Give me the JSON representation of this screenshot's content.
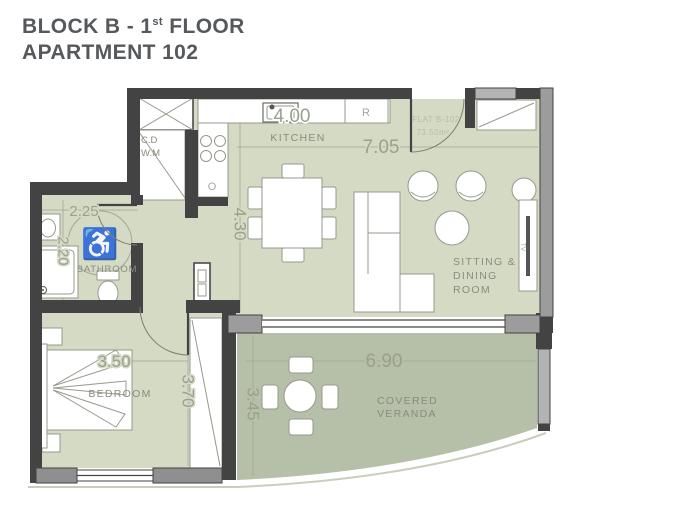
{
  "title": {
    "line1_prefix": "BLOCK B - 1",
    "line1_sup": "st",
    "line1_suffix": " FLOOR",
    "line2": "APARTMENT 102"
  },
  "plan": {
    "flat": {
      "name": "FLAT B-102",
      "area": "73.50m²"
    },
    "rooms": {
      "kitchen": {
        "label": "KITCHEN"
      },
      "sitting": {
        "line1": "SITTING &",
        "line2": "DINING",
        "line3": "ROOM"
      },
      "bathroom": {
        "label": "BATHROOM"
      },
      "bedroom": {
        "label": "BEDROOM"
      },
      "veranda": {
        "line1": "COVERED",
        "line2": "VERANDA"
      }
    },
    "dimensions": {
      "kitchen_width": "4.00",
      "living_width": "7.05",
      "kitchen_depth": "4.30",
      "bathroom_width": "2.25",
      "bathroom_depth": "2.20",
      "bedroom_width": "3.50",
      "bedroom_depth": "3.70",
      "veranda_width": "6.90",
      "veranda_depth": "3.45"
    },
    "appliances": {
      "refrigerator": "R",
      "oven": "O",
      "cupboard": "C.D",
      "washing_machine": "W.M",
      "tv": "TV"
    },
    "accessibility_icon": "♿"
  },
  "colors": {
    "floor": "#d5dac5",
    "veranda_floor": "#b6bfa7",
    "wall_dark": "#434343",
    "wall_gray": "#9c9c9c",
    "title_text": "#56595c",
    "label_text": "#878d7e",
    "dimension_text": "#99a08c"
  }
}
